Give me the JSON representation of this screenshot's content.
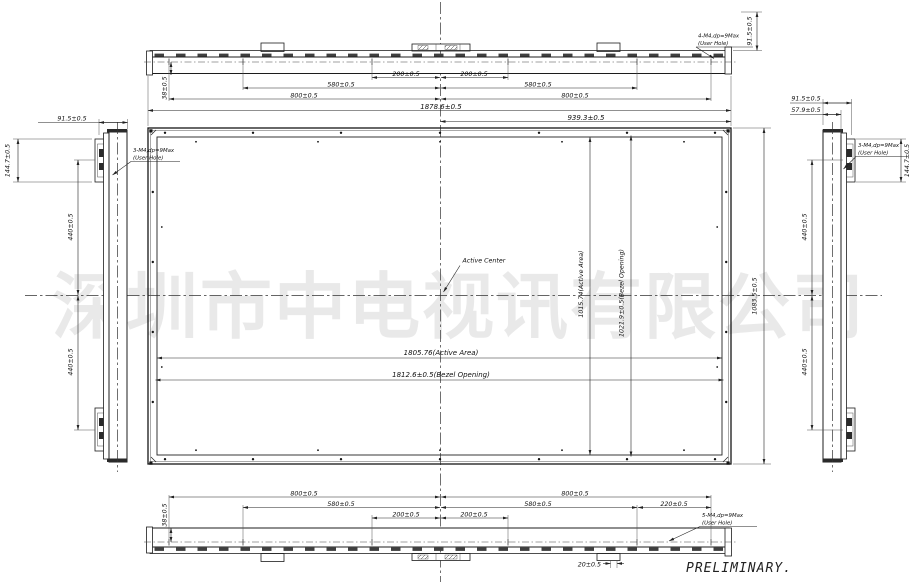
{
  "watermark_text": "深圳市中电视讯有限公司",
  "preliminary_label": "PRELIMINARY.",
  "notes": {
    "top": {
      "line1": "4-M4,dp=9Max",
      "line2": "(User Hole)"
    },
    "left": {
      "line1": "3-M4,dp=9Max",
      "line2": "(User Hole)"
    },
    "right": {
      "line1": "3-M4,dp=9Max",
      "line2": "(User Hole)"
    },
    "bottom": {
      "line1": "5-M4,dp=9Max",
      "line2": "(User Hole)"
    }
  },
  "front": {
    "active_center_label": "Active Center",
    "active_area_width": "1805.76(Active Area)",
    "bezel_opening_width": "1812.6±0.5(Bezel Opening)",
    "active_area_height": "1015.74(Active Area)",
    "bezel_opening_height": "1021.9±0.5(Bezel Opening)",
    "overall_width": "1878.6±0.5",
    "half_width": "939.3±0.5",
    "overall_height": "1083.5±0.5"
  },
  "top_view": {
    "d200_left": "200±0.5",
    "d200_right": "200±0.5",
    "d580_left": "580±0.5",
    "d580_right": "580±0.5",
    "d800_left": "800±0.5",
    "d800_right": "800±0.5",
    "d38": "38±0.5",
    "d91_5": "91.5±0.5"
  },
  "bottom_view": {
    "d200_left": "200±0.5",
    "d200_right": "200±0.5",
    "d580_left": "580±0.5",
    "d580_right": "580±0.5",
    "d800_left": "800±0.5",
    "d800_right": "800±0.5",
    "d220": "220±0.5",
    "d20": "20±0.5",
    "d38": "38±0.5"
  },
  "left_view": {
    "d91_5": "91.5±0.5",
    "d144_7": "144.7±0.5",
    "d440_upper": "440±0.5",
    "d440_lower": "440±0.5"
  },
  "right_view": {
    "d91_5": "91.5±0.5",
    "d57_9": "57.9±0.5",
    "d144_7": "144.7±0.5",
    "d440_upper": "440±0.5",
    "d440_lower": "440±0.5"
  }
}
